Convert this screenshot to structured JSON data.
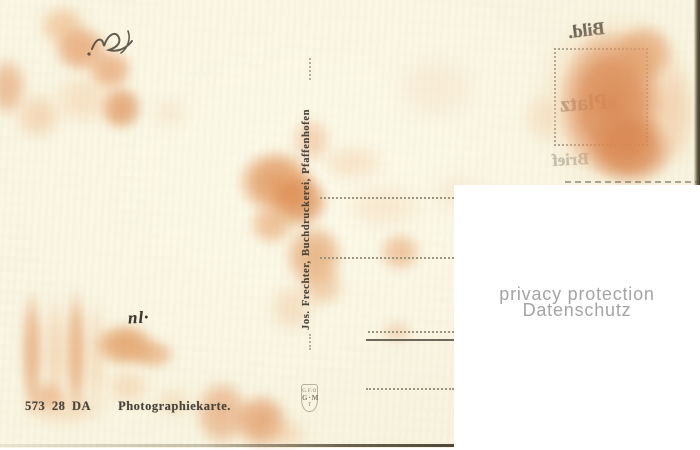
{
  "card": {
    "series_number": "573 28 DA",
    "card_type": "Photographiekarte.",
    "publisher_imprint": "Jos. Frechter, Buchdruckerei, Pfaffenhofen",
    "emblem": {
      "l1": "G.F.O",
      "l2": "G·M",
      "l3": "T"
    }
  },
  "ink_offsets": {
    "top": "Bild.",
    "middle": "Platz",
    "bottom": "Brief"
  },
  "handwriting": {
    "bottom_mark": "nl·"
  },
  "watermark": {
    "line1": "privacy protection",
    "line2": "Datenschutz"
  },
  "colors": {
    "card_cream": "#f9f5e1",
    "stain_strong": "#d8844e",
    "stain_medium": "#e5a06c",
    "stain_pale": "#f2cda4",
    "print_ink": "#49443b",
    "watermark_gray": "#a4a4a4"
  },
  "decor": {
    "address_lines": [
      {
        "x": 320,
        "y": 197,
        "w": 134,
        "style": "dotted"
      },
      {
        "x": 320,
        "y": 257,
        "w": 134,
        "style": "dotted"
      },
      {
        "x": 368,
        "y": 331,
        "w": 86,
        "style": "dotted"
      },
      {
        "x": 366,
        "y": 339,
        "w": 88,
        "style": "solid"
      },
      {
        "x": 366,
        "y": 388,
        "w": 88,
        "style": "dotted"
      }
    ],
    "stains": [
      [
        38,
        4,
        50,
        44,
        "#eebd8e",
        0.75,
        5
      ],
      [
        52,
        24,
        58,
        50,
        "#e5a06c",
        0.8,
        4
      ],
      [
        86,
        48,
        48,
        44,
        "#e5a06c",
        0.75,
        4
      ],
      [
        98,
        84,
        46,
        48,
        "#df9660",
        0.8,
        4
      ],
      [
        -14,
        56,
        42,
        62,
        "#e5a474",
        0.7,
        5
      ],
      [
        14,
        92,
        48,
        48,
        "#efc094",
        0.6,
        6
      ],
      [
        52,
        72,
        64,
        54,
        "#f2cda4",
        0.55,
        7
      ],
      [
        150,
        95,
        40,
        35,
        "#f4d6b2",
        0.4,
        7
      ],
      [
        236,
        148,
        80,
        68,
        "#df9054",
        0.85,
        4
      ],
      [
        268,
        172,
        62,
        58,
        "#dc8b50",
        0.85,
        4
      ],
      [
        248,
        202,
        48,
        44,
        "#e7a770",
        0.7,
        5
      ],
      [
        283,
        222,
        62,
        68,
        "#e3a06a",
        0.75,
        4
      ],
      [
        298,
        264,
        48,
        44,
        "#eab584",
        0.6,
        5
      ],
      [
        318,
        144,
        68,
        38,
        "#f2cda4",
        0.5,
        7
      ],
      [
        342,
        182,
        84,
        48,
        "#f4d5b0",
        0.45,
        8
      ],
      [
        378,
        232,
        44,
        40,
        "#e8a874",
        0.65,
        5
      ],
      [
        290,
        116,
        42,
        48,
        "#ecb183",
        0.55,
        5
      ],
      [
        268,
        282,
        48,
        52,
        "#f0c69c",
        0.5,
        6
      ],
      [
        381,
        320,
        32,
        24,
        "#ecb78a",
        0.5,
        5
      ],
      [
        20,
        288,
        24,
        128,
        "#e4a06c",
        0.7,
        4
      ],
      [
        44,
        293,
        22,
        122,
        "#eebf92",
        0.55,
        5
      ],
      [
        64,
        286,
        24,
        132,
        "#e3a06a",
        0.7,
        4
      ],
      [
        86,
        298,
        20,
        117,
        "#efc59a",
        0.5,
        5
      ],
      [
        18,
        392,
        90,
        34,
        "#f0c89e",
        0.5,
        6
      ],
      [
        93,
        322,
        64,
        46,
        "#e09659",
        0.8,
        4
      ],
      [
        128,
        338,
        48,
        32,
        "#e5a671",
        0.7,
        4
      ],
      [
        106,
        368,
        44,
        38,
        "#f0c296",
        0.5,
        6
      ],
      [
        28,
        380,
        38,
        32,
        "#e7a978",
        0.65,
        5
      ],
      [
        155,
        388,
        38,
        30,
        "#f1ca9f",
        0.5,
        6
      ],
      [
        193,
        378,
        58,
        70,
        "#e4a373",
        0.7,
        4
      ],
      [
        232,
        392,
        58,
        58,
        "#df945e",
        0.75,
        4
      ],
      [
        264,
        418,
        44,
        32,
        "#efc094",
        0.5,
        6
      ],
      [
        536,
        12,
        156,
        176,
        "#f1c59a",
        0.6,
        7
      ],
      [
        558,
        28,
        108,
        152,
        "#d8844e",
        0.9,
        3
      ],
      [
        588,
        112,
        88,
        74,
        "#d8854e",
        0.85,
        3
      ],
      [
        612,
        22,
        64,
        62,
        "#e19a64",
        0.7,
        4
      ],
      [
        652,
        58,
        44,
        112,
        "#eec39c",
        0.5,
        6
      ],
      [
        522,
        92,
        42,
        52,
        "#f2d0aa",
        0.45,
        6
      ],
      [
        392,
        52,
        88,
        72,
        "#f6dec2",
        0.45,
        8
      ],
      [
        428,
        172,
        62,
        42,
        "#f4d8b8",
        0.4,
        8
      ]
    ]
  }
}
